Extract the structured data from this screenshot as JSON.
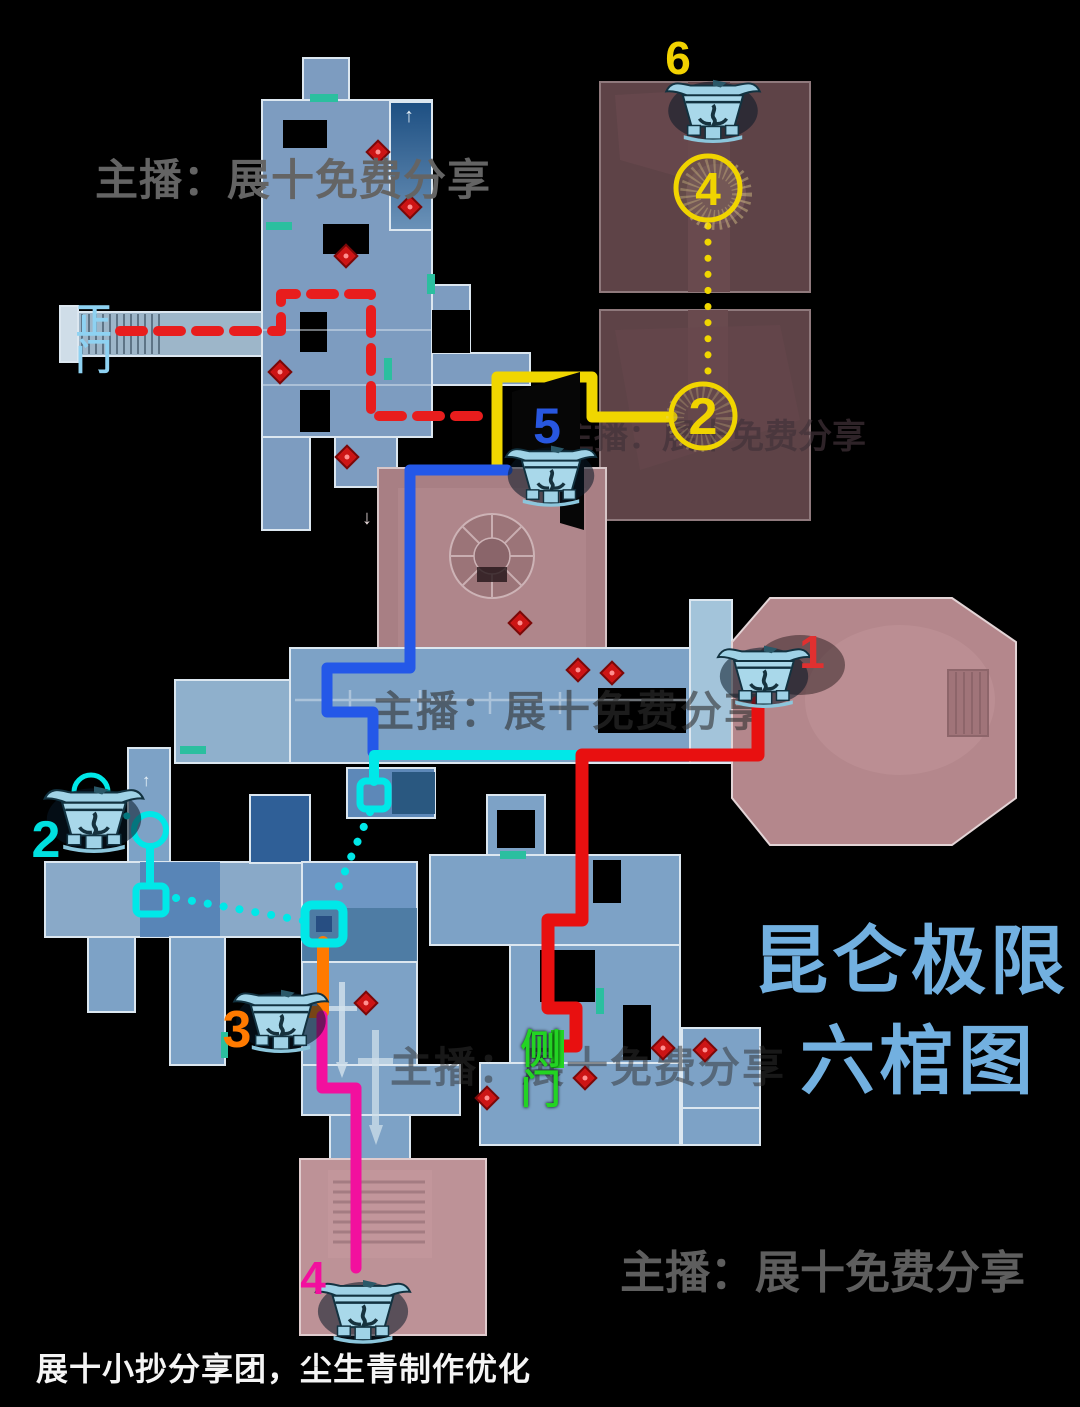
{
  "canvas": {
    "width": 1080,
    "height": 1407,
    "background": "#000000"
  },
  "title": {
    "line1": "昆仑极限",
    "line2": "六棺图",
    "color": "#72b0e0"
  },
  "watermarks": {
    "streamer": "主播：展十免费分享"
  },
  "credit": {
    "text": "展十小抄分享团，尘生青制作优化"
  },
  "gates": {
    "main": {
      "label": "正门",
      "color": "#8ed2f2"
    },
    "side": {
      "label": "侧门",
      "color": "#23d423"
    }
  },
  "coffins": [
    {
      "num": "1",
      "color": "#e03030"
    },
    {
      "num": "2",
      "color": "#00e0e0"
    },
    {
      "num": "3",
      "color": "#ff7a00"
    },
    {
      "num": "4",
      "color": "#f2109e"
    },
    {
      "num": "5",
      "color": "#2857e0"
    },
    {
      "num": "6",
      "color": "#f2d200"
    }
  ],
  "circles": [
    {
      "num": "4",
      "color": "#f0d400"
    },
    {
      "num": "2",
      "color": "#f0d400"
    }
  ],
  "routes": {
    "main_gate": {
      "color": "#e81d1d",
      "style": "dashed"
    },
    "yellow": {
      "color": "#f0d600",
      "style": "solid"
    },
    "yellow_dotted": {
      "color": "#f0d600",
      "style": "dotted"
    },
    "blue": {
      "color": "#2458e8",
      "style": "solid"
    },
    "cyan": {
      "color": "#00e8e8",
      "style": "solid"
    },
    "cyan_dotted": {
      "color": "#00e8e8",
      "style": "dotted"
    },
    "orange": {
      "color": "#ff7a00",
      "style": "solid"
    },
    "magenta": {
      "color": "#f2109e",
      "style": "solid"
    },
    "red": {
      "color": "#e81010",
      "style": "solid"
    }
  },
  "glyphs": {
    "up_arrow": "↑",
    "down_arrow": "↓"
  }
}
